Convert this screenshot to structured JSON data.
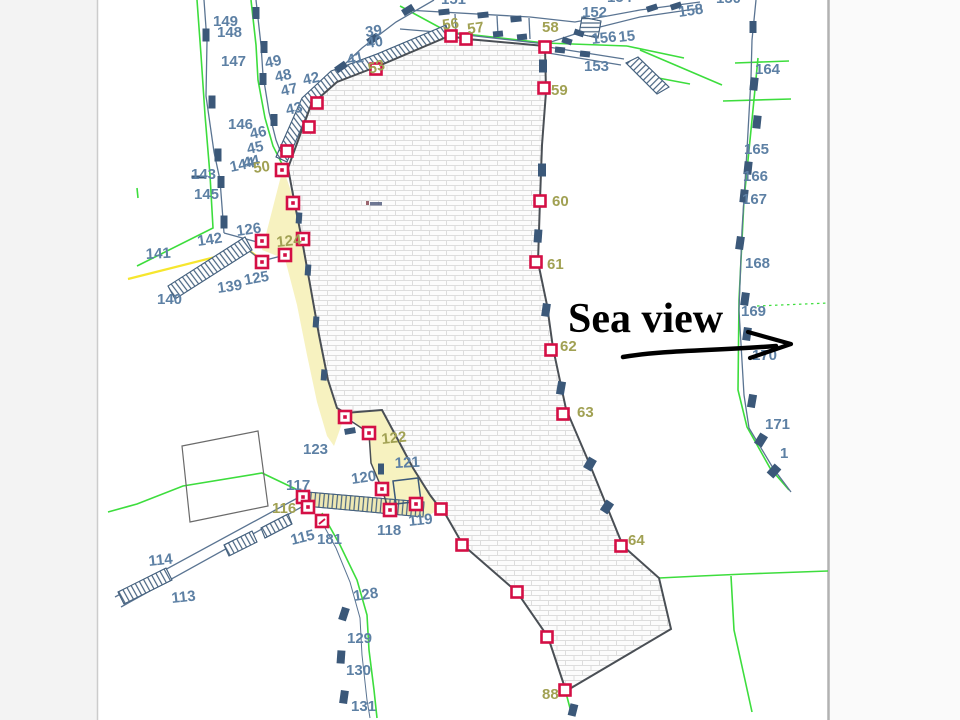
{
  "canvas": {
    "width": 960,
    "height": 720
  },
  "frame": {
    "left_bar_color": "#f3f3f3",
    "right_bar_color": "#fafafa",
    "panel_color": "#ffffff",
    "left_divider": "#cccccc",
    "right_divider": "#b2b2b2",
    "panel_left": 98,
    "panel_right": 828
  },
  "palette": {
    "label_blue": "#5d80a4",
    "label_olive": "#a1a153",
    "red_marker": "#d40f45",
    "dark_mark": "#3b5879",
    "green_line": "#3ddd3d",
    "yellow_line": "#f6e62e",
    "parcel_yellow": "#f7f2c0",
    "band_yellow": "#efe9b4",
    "road_line": "#5a7492",
    "polygon_outline": "#4a4f55",
    "brick_line": "#dddddd",
    "brick_fill": "#fcfcfc"
  },
  "annotation": {
    "sea_view_label": "Sea view"
  },
  "point_labels": [
    {
      "t": "149",
      "x": 213,
      "y": 26,
      "c": "b",
      "r": 0
    },
    {
      "t": "148",
      "x": 217,
      "y": 37,
      "c": "b",
      "r": 0
    },
    {
      "t": "147",
      "x": 221,
      "y": 66,
      "c": "b",
      "r": 0
    },
    {
      "t": "146",
      "x": 228,
      "y": 129,
      "c": "b",
      "r": 0
    },
    {
      "t": "143",
      "x": 191,
      "y": 179,
      "c": "b",
      "r": 0
    },
    {
      "t": "145",
      "x": 194,
      "y": 199,
      "c": "b",
      "r": 0
    },
    {
      "t": "144",
      "x": 231,
      "y": 172,
      "c": "b",
      "r": -12
    },
    {
      "t": "44",
      "x": 244,
      "y": 168,
      "c": "b",
      "r": -12
    },
    {
      "t": "45",
      "x": 248,
      "y": 154,
      "c": "b",
      "r": -12
    },
    {
      "t": "46",
      "x": 251,
      "y": 139,
      "c": "b",
      "r": -12
    },
    {
      "t": "49",
      "x": 266,
      "y": 68,
      "c": "b",
      "r": -12
    },
    {
      "t": "48",
      "x": 276,
      "y": 82,
      "c": "b",
      "r": -12
    },
    {
      "t": "47",
      "x": 282,
      "y": 96,
      "c": "b",
      "r": -12
    },
    {
      "t": "43",
      "x": 287,
      "y": 115,
      "c": "b",
      "r": -12
    },
    {
      "t": "42",
      "x": 304,
      "y": 85,
      "c": "b",
      "r": -12
    },
    {
      "t": "41",
      "x": 348,
      "y": 65,
      "c": "b",
      "r": -12
    },
    {
      "t": "39",
      "x": 366,
      "y": 37,
      "c": "b",
      "r": -8
    },
    {
      "t": "40",
      "x": 367,
      "y": 48,
      "c": "b",
      "r": -8
    },
    {
      "t": "53",
      "x": 370,
      "y": 74,
      "c": "o",
      "r": -18
    },
    {
      "t": "50",
      "x": 254,
      "y": 173,
      "c": "o",
      "r": -8
    },
    {
      "t": "126",
      "x": 237,
      "y": 236,
      "c": "b",
      "r": -8
    },
    {
      "t": "124",
      "x": 277,
      "y": 247,
      "c": "o",
      "r": -6
    },
    {
      "t": "142",
      "x": 198,
      "y": 246,
      "c": "b",
      "r": -8
    },
    {
      "t": "141",
      "x": 146,
      "y": 259,
      "c": "b",
      "r": -3
    },
    {
      "t": "125",
      "x": 245,
      "y": 285,
      "c": "b",
      "r": -10
    },
    {
      "t": "139",
      "x": 218,
      "y": 293,
      "c": "b",
      "r": -8
    },
    {
      "t": "140",
      "x": 157,
      "y": 304,
      "c": "b",
      "r": 0
    },
    {
      "t": "123",
      "x": 303,
      "y": 454,
      "c": "b",
      "r": 0
    },
    {
      "t": "122",
      "x": 382,
      "y": 444,
      "c": "o",
      "r": -6
    },
    {
      "t": "121",
      "x": 395,
      "y": 468,
      "c": "b",
      "r": -3
    },
    {
      "t": "120",
      "x": 352,
      "y": 484,
      "c": "b",
      "r": -8
    },
    {
      "t": "117",
      "x": 286,
      "y": 490,
      "c": "b",
      "r": 0
    },
    {
      "t": "116",
      "x": 272,
      "y": 513,
      "c": "o",
      "r": 0
    },
    {
      "t": "115",
      "x": 292,
      "y": 545,
      "c": "b",
      "r": -14
    },
    {
      "t": "181",
      "x": 317,
      "y": 544,
      "c": "b",
      "r": 0
    },
    {
      "t": "118",
      "x": 377,
      "y": 535,
      "c": "b",
      "r": 0
    },
    {
      "t": "119",
      "x": 409,
      "y": 526,
      "c": "b",
      "r": -6
    },
    {
      "t": "114",
      "x": 149,
      "y": 566,
      "c": "b",
      "r": -6
    },
    {
      "t": "113",
      "x": 172,
      "y": 603,
      "c": "b",
      "r": -6
    },
    {
      "t": "128",
      "x": 354,
      "y": 601,
      "c": "b",
      "r": -8
    },
    {
      "t": "129",
      "x": 347,
      "y": 643,
      "c": "b",
      "r": 0
    },
    {
      "t": "130",
      "x": 346,
      "y": 675,
      "c": "b",
      "r": 0
    },
    {
      "t": "131",
      "x": 351,
      "y": 711,
      "c": "b",
      "r": 0
    },
    {
      "t": "151",
      "x": 441,
      "y": 4,
      "c": "b",
      "r": 0
    },
    {
      "t": "152",
      "x": 582,
      "y": 17,
      "c": "b",
      "r": 0
    },
    {
      "t": "154",
      "x": 607,
      "y": 2,
      "c": "b",
      "r": 0
    },
    {
      "t": "156",
      "x": 592,
      "y": 44,
      "c": "b",
      "r": -6
    },
    {
      "t": "15",
      "x": 619,
      "y": 42,
      "c": "b",
      "r": -6
    },
    {
      "t": "153",
      "x": 584,
      "y": 71,
      "c": "b",
      "r": 0
    },
    {
      "t": "158",
      "x": 679,
      "y": 17,
      "c": "b",
      "r": -8
    },
    {
      "t": "150",
      "x": 716,
      "y": 3,
      "c": "b",
      "r": 0
    },
    {
      "t": "164",
      "x": 755,
      "y": 74,
      "c": "b",
      "r": 0
    },
    {
      "t": "165",
      "x": 744,
      "y": 154,
      "c": "b",
      "r": 0
    },
    {
      "t": "166",
      "x": 743,
      "y": 181,
      "c": "b",
      "r": 0
    },
    {
      "t": "167",
      "x": 742,
      "y": 204,
      "c": "b",
      "r": 0
    },
    {
      "t": "168",
      "x": 745,
      "y": 268,
      "c": "b",
      "r": 0
    },
    {
      "t": "169",
      "x": 741,
      "y": 316,
      "c": "b",
      "r": 0
    },
    {
      "t": "170",
      "x": 752,
      "y": 360,
      "c": "b",
      "r": 0
    },
    {
      "t": "171",
      "x": 765,
      "y": 429,
      "c": "b",
      "r": 0
    },
    {
      "t": "1",
      "x": 780,
      "y": 458,
      "c": "b",
      "r": 0
    },
    {
      "t": "56",
      "x": 443,
      "y": 30,
      "c": "o",
      "r": -8
    },
    {
      "t": "57",
      "x": 468,
      "y": 34,
      "c": "o",
      "r": -8
    },
    {
      "t": "58",
      "x": 542,
      "y": 32,
      "c": "o",
      "r": 0
    },
    {
      "t": "59",
      "x": 551,
      "y": 95,
      "c": "o",
      "r": 0
    },
    {
      "t": "60",
      "x": 552,
      "y": 206,
      "c": "o",
      "r": 0
    },
    {
      "t": "61",
      "x": 547,
      "y": 269,
      "c": "o",
      "r": 0
    },
    {
      "t": "62",
      "x": 560,
      "y": 351,
      "c": "o",
      "r": 0
    },
    {
      "t": "63",
      "x": 577,
      "y": 417,
      "c": "o",
      "r": 0
    },
    {
      "t": "64",
      "x": 628,
      "y": 545,
      "c": "o",
      "r": 0
    },
    {
      "t": "88",
      "x": 542,
      "y": 699,
      "c": "o",
      "r": 0
    }
  ],
  "red_markers": [
    {
      "x": 282,
      "y": 170,
      "k": "dot"
    },
    {
      "x": 287,
      "y": 151,
      "k": "open"
    },
    {
      "x": 317,
      "y": 103,
      "k": "open"
    },
    {
      "x": 309,
      "y": 127,
      "k": "open"
    },
    {
      "x": 376,
      "y": 69,
      "k": "open"
    },
    {
      "x": 451,
      "y": 36,
      "k": "open"
    },
    {
      "x": 466,
      "y": 39,
      "k": "open"
    },
    {
      "x": 545,
      "y": 47,
      "k": "open"
    },
    {
      "x": 544,
      "y": 88,
      "k": "open"
    },
    {
      "x": 540,
      "y": 201,
      "k": "open"
    },
    {
      "x": 536,
      "y": 262,
      "k": "open"
    },
    {
      "x": 551,
      "y": 350,
      "k": "open"
    },
    {
      "x": 563,
      "y": 414,
      "k": "open"
    },
    {
      "x": 621,
      "y": 546,
      "k": "open"
    },
    {
      "x": 565,
      "y": 690,
      "k": "open"
    },
    {
      "x": 517,
      "y": 592,
      "k": "open"
    },
    {
      "x": 547,
      "y": 637,
      "k": "open"
    },
    {
      "x": 462,
      "y": 545,
      "k": "open"
    },
    {
      "x": 441,
      "y": 509,
      "k": "open"
    },
    {
      "x": 293,
      "y": 203,
      "k": "dot"
    },
    {
      "x": 303,
      "y": 239,
      "k": "dot"
    },
    {
      "x": 262,
      "y": 241,
      "k": "dot"
    },
    {
      "x": 262,
      "y": 262,
      "k": "dot"
    },
    {
      "x": 285,
      "y": 255,
      "k": "dot"
    },
    {
      "x": 345,
      "y": 417,
      "k": "dot"
    },
    {
      "x": 369,
      "y": 433,
      "k": "dot"
    },
    {
      "x": 382,
      "y": 489,
      "k": "dot"
    },
    {
      "x": 390,
      "y": 510,
      "k": "dot"
    },
    {
      "x": 416,
      "y": 504,
      "k": "dot"
    },
    {
      "x": 303,
      "y": 497,
      "k": "dot"
    },
    {
      "x": 308,
      "y": 507,
      "k": "dot"
    },
    {
      "x": 322,
      "y": 521,
      "k": "tick"
    }
  ],
  "survey_marks": [
    [
      206,
      35,
      7,
      13,
      0
    ],
    [
      212,
      102,
      7,
      13,
      0
    ],
    [
      218,
      155,
      7,
      13,
      0
    ],
    [
      221,
      182,
      7,
      12,
      0
    ],
    [
      224,
      222,
      7,
      13,
      0
    ],
    [
      199,
      177,
      15,
      3,
      0
    ],
    [
      256,
      13,
      7,
      12,
      0
    ],
    [
      264,
      47,
      7,
      12,
      0
    ],
    [
      263,
      79,
      7,
      12,
      0
    ],
    [
      274,
      120,
      7,
      12,
      0
    ],
    [
      408,
      10,
      12,
      7,
      -32
    ],
    [
      373,
      39,
      12,
      7,
      -35
    ],
    [
      341,
      67,
      12,
      7,
      -35
    ],
    [
      444,
      12,
      11,
      6,
      -6
    ],
    [
      483,
      15,
      11,
      6,
      -6
    ],
    [
      516,
      19,
      11,
      6,
      -6
    ],
    [
      498,
      34,
      10,
      6,
      -6
    ],
    [
      522,
      37,
      10,
      6,
      -6
    ],
    [
      567,
      41,
      10,
      6,
      18
    ],
    [
      579,
      33,
      10,
      6,
      18
    ],
    [
      652,
      8,
      11,
      6,
      -18
    ],
    [
      676,
      6,
      11,
      6,
      -18
    ],
    [
      560,
      50,
      10,
      6,
      6
    ],
    [
      585,
      54,
      10,
      6,
      6
    ],
    [
      753,
      27,
      7,
      12,
      0
    ],
    [
      754,
      84,
      8,
      13,
      6
    ],
    [
      757,
      122,
      8,
      13,
      6
    ],
    [
      748,
      168,
      8,
      13,
      6
    ],
    [
      744,
      196,
      8,
      13,
      6
    ],
    [
      740,
      243,
      8,
      13,
      8
    ],
    [
      745,
      299,
      8,
      13,
      8
    ],
    [
      747,
      334,
      8,
      13,
      8
    ],
    [
      752,
      401,
      8,
      13,
      10
    ],
    [
      761,
      440,
      9,
      12,
      32
    ],
    [
      774,
      471,
      9,
      12,
      42
    ],
    [
      543,
      66,
      8,
      13,
      0
    ],
    [
      542,
      170,
      8,
      13,
      0
    ],
    [
      538,
      236,
      8,
      13,
      4
    ],
    [
      546,
      310,
      8,
      13,
      8
    ],
    [
      561,
      388,
      8,
      13,
      10
    ],
    [
      590,
      464,
      9,
      12,
      30
    ],
    [
      607,
      507,
      9,
      12,
      34
    ],
    [
      573,
      710,
      8,
      12,
      14
    ],
    [
      344,
      614,
      8,
      13,
      18
    ],
    [
      341,
      657,
      8,
      13,
      4
    ],
    [
      344,
      697,
      8,
      13,
      8
    ],
    [
      299,
      218,
      6,
      11,
      4
    ],
    [
      308,
      270,
      6,
      11,
      4
    ],
    [
      316,
      322,
      6,
      11,
      4
    ],
    [
      324,
      375,
      6,
      11,
      4
    ],
    [
      350,
      431,
      11,
      6,
      -10
    ],
    [
      381,
      469,
      6,
      11,
      0
    ]
  ]
}
